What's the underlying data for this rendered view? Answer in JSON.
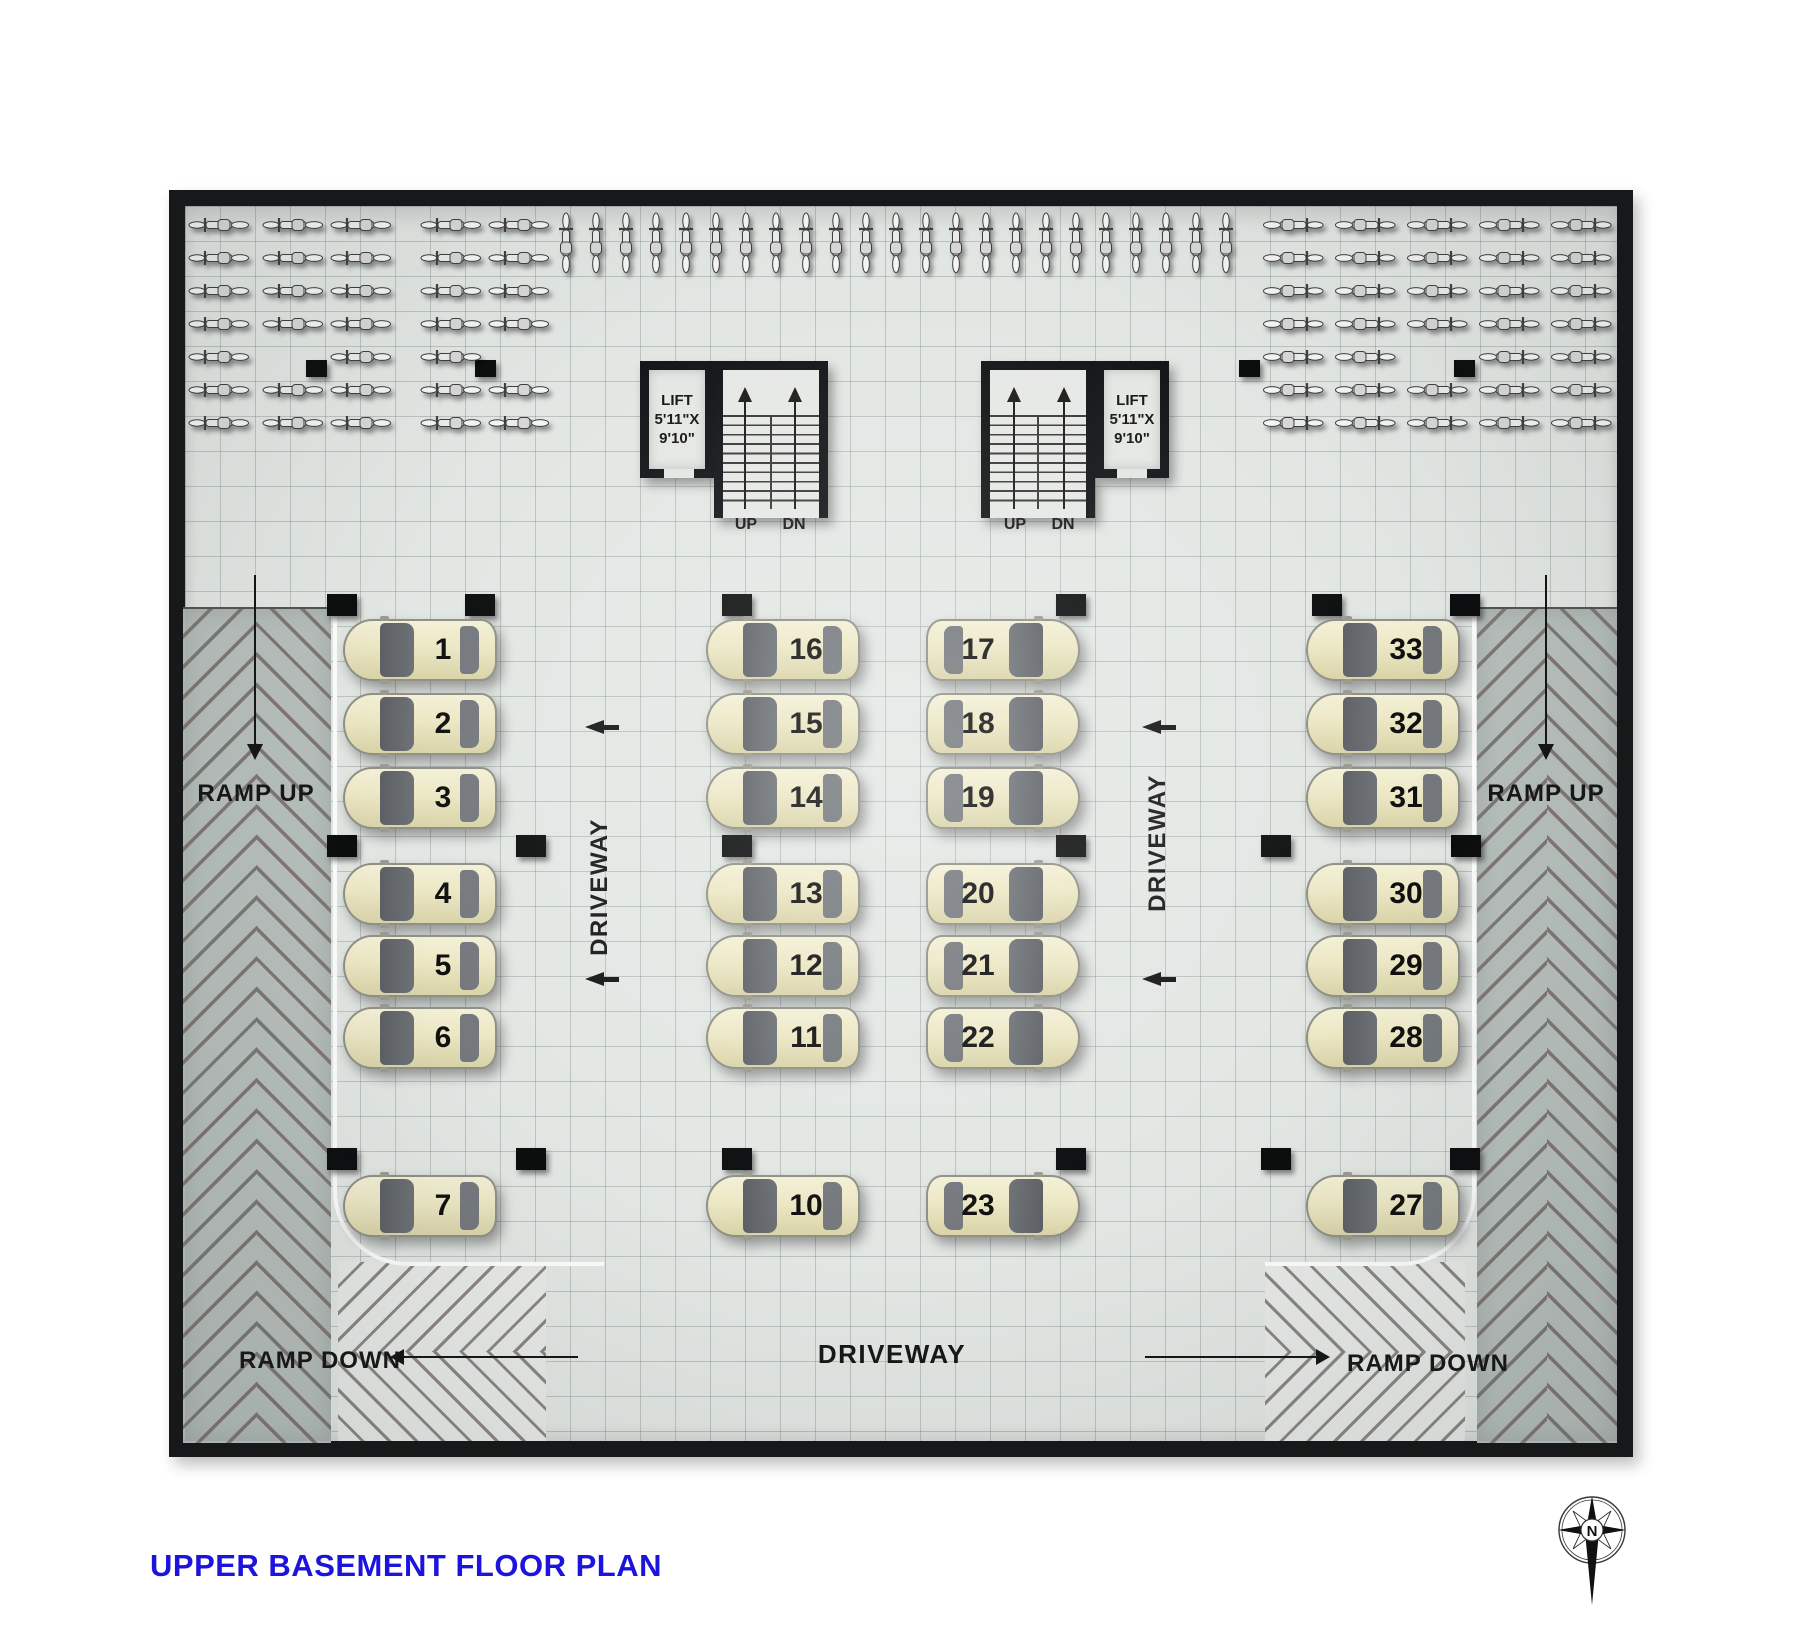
{
  "title": "UPPER BASEMENT FLOOR PLAN",
  "labels": {
    "ramp_up": "RAMP UP",
    "ramp_down": "RAMP DOWN",
    "driveway": "DRIVEWAY",
    "stairs_up": "UP",
    "stairs_down": "DN",
    "lift": "LIFT\n5'11\"X\n9'10\"",
    "compass_north": "N"
  },
  "colors": {
    "title_blue": "#1c13dd",
    "wall_black": "#17181a",
    "floor_gray": "#e3e7e4",
    "ramp_gray": "#b7bfbc",
    "chevron_gray": "#7e7774",
    "car_body_cream": "#ece7c4",
    "car_glass_gray": "#62666b",
    "label_dark": "#161616"
  },
  "parking": {
    "row_ys": [
      650,
      724,
      798,
      894,
      966,
      1038,
      1206
    ],
    "columns": [
      {
        "id": "left",
        "x": 342,
        "flip": false,
        "numbers": [
          "1",
          "2",
          "3",
          "4",
          "5",
          "6",
          "7"
        ]
      },
      {
        "id": "mid-left",
        "x": 705,
        "flip": false,
        "numbers": [
          "16",
          "15",
          "14",
          "13",
          "12",
          "11",
          "10"
        ]
      },
      {
        "id": "mid-right",
        "x": 925,
        "flip": true,
        "numbers": [
          "17",
          "18",
          "19",
          "20",
          "21",
          "22",
          "23"
        ]
      },
      {
        "id": "right",
        "x": 1305,
        "flip": false,
        "numbers": [
          "33",
          "32",
          "31",
          "30",
          "29",
          "28",
          "27"
        ]
      }
    ]
  },
  "pillars": {
    "large": [
      [
        342,
        605
      ],
      [
        480,
        605
      ],
      [
        737,
        605
      ],
      [
        1071,
        605
      ],
      [
        1327,
        605
      ],
      [
        1465,
        605
      ],
      [
        342,
        846
      ],
      [
        531,
        846
      ],
      [
        737,
        846
      ],
      [
        1071,
        846
      ],
      [
        1276,
        846
      ],
      [
        1466,
        846
      ],
      [
        342,
        1159
      ],
      [
        531,
        1159
      ],
      [
        737,
        1159
      ],
      [
        1071,
        1159
      ],
      [
        1276,
        1159
      ],
      [
        1465,
        1159
      ]
    ],
    "small": [
      [
        316,
        368
      ],
      [
        485,
        368
      ],
      [
        1249,
        368
      ],
      [
        1464,
        368
      ]
    ]
  },
  "bikes": {
    "left_columns_x": [
      188,
      262,
      330,
      420,
      488
    ],
    "right_columns_x": [
      1262,
      1334,
      1406,
      1478,
      1550
    ],
    "row_y_start": 215,
    "row_step": 33,
    "rows": 7,
    "left_skip": [
      [
        1,
        4
      ],
      [
        4,
        4
      ]
    ],
    "right_skip": [
      [
        2,
        4
      ]
    ],
    "vertical_row": {
      "x_start": 556,
      "step": 30,
      "count": 23,
      "y": 212
    }
  },
  "driveway_arrows": [
    [
      603,
      727
    ],
    [
      603,
      979
    ],
    [
      1160,
      727
    ],
    [
      1160,
      979
    ]
  ]
}
